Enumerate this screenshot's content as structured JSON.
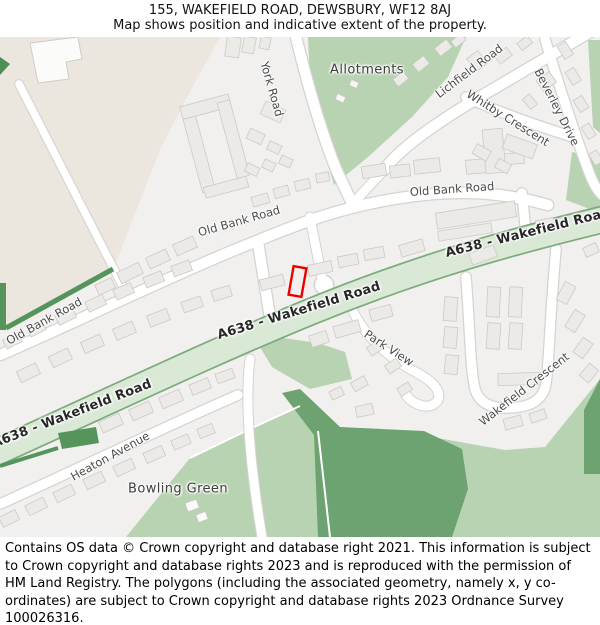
{
  "header": {
    "title": "155, WAKEFIELD ROAD, DEWSBURY, WF12 8AJ",
    "subtitle": "Map shows position and indicative extent of the property."
  },
  "map": {
    "labels": {
      "allotments": "Allotments",
      "york_road": "York Road",
      "lichfield_road": "Lichfield Road",
      "whitby_crescent": "Whitby Crescent",
      "beverley_drive": "Beverley Drive",
      "old_bank_road_left": "Old Bank Road",
      "old_bank_road_center": "Old Bank Road",
      "old_bank_road_right": "Old Bank Road",
      "a638_top_right": "A638 - Wakefield Road",
      "a638_center": "A638 - Wakefield Road",
      "a638_bottom_left": "A638 - Wakefield Road",
      "park_view": "Park View",
      "wakefield_crescent": "Wakefield Crescent",
      "heaton_avenue": "Heaton Avenue",
      "bowling_green": "Bowling Green"
    },
    "property_marker": {
      "color": "#ee0000",
      "description": "Red outline marking position and indicative extent of 155 Wakefield Road"
    },
    "colors": {
      "background": "#f1f0ee",
      "industrial_area": "#ebe6de",
      "green_area": "#b7d3b1",
      "dark_green": "#6da271",
      "hedge_green": "#55945b",
      "a638_fill": "#d9e9d6",
      "a638_border": "#7dab7e",
      "building": "#ebeae7"
    }
  },
  "footer": {
    "text": "Contains OS data © Crown copyright and database right 2021. This information is subject to Crown copyright and database rights 2023 and is reproduced with the permission of HM Land Registry. The polygons (including the associated geometry, namely x, y co-ordinates) are subject to Crown copyright and database rights 2023 Ordnance Survey 100026316."
  }
}
